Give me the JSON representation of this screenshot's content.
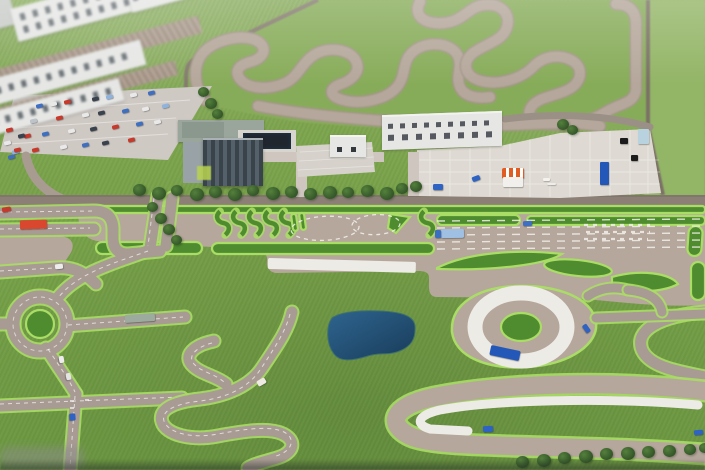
{
  "scene": {
    "subject": "Aerial photograph of a miniature scale model of a vehicle proving ground and driver training facility",
    "features": [
      "winding handling course",
      "grandstand buildings",
      "visitor parking lot with cars",
      "office building",
      "workshop hall",
      "concrete apron with equipment",
      "slalom practice islands",
      "dashed steering circles",
      "multi-lane braking straight with white stripe",
      "roundabout",
      "city practice streets",
      "serpentine practice road",
      "dark blue pond",
      "wet skid pad ring",
      "high-speed hairpin bend with white curve marking",
      "tree rows"
    ]
  },
  "colors": {
    "grass_base": "#79a24a",
    "grass_field": "#87ac59",
    "grass_right": "#93b566",
    "island_green": "#4f8c30",
    "island_edge": "#aadd66",
    "track_tan": "#b5a79b",
    "road_grey": "#a89b93",
    "main_road": "#8c8076",
    "apron": "#dedad3",
    "white_paint": "#edebe5",
    "building_white": "#e6e7e5",
    "glass_dark": "#4b555c",
    "pond_dark": "#16395b",
    "pond_light": "#2d6492",
    "tent_orange": "#e05c22",
    "border_brown": "#7b7166"
  },
  "vehicles": {
    "parked_cars": [
      {
        "x": 36,
        "y": 104,
        "c": "#3f6fc0"
      },
      {
        "x": 50,
        "y": 102,
        "c": "#e9e9e9"
      },
      {
        "x": 64,
        "y": 100,
        "c": "#c6392b"
      },
      {
        "x": 92,
        "y": 97,
        "c": "#39424d"
      },
      {
        "x": 106,
        "y": 95,
        "c": "#8fb3dd"
      },
      {
        "x": 130,
        "y": 93,
        "c": "#e9e9e9"
      },
      {
        "x": 148,
        "y": 91,
        "c": "#3f6fc0"
      },
      {
        "x": 30,
        "y": 119,
        "c": "#bcc3c9"
      },
      {
        "x": 56,
        "y": 116,
        "c": "#c6392b"
      },
      {
        "x": 82,
        "y": 113,
        "c": "#e9e9e9"
      },
      {
        "x": 98,
        "y": 111,
        "c": "#39424d"
      },
      {
        "x": 122,
        "y": 109,
        "c": "#3f6fc0"
      },
      {
        "x": 142,
        "y": 107,
        "c": "#e9e9e9"
      },
      {
        "x": 162,
        "y": 104,
        "c": "#8fb3dd"
      },
      {
        "x": 24,
        "y": 134,
        "c": "#c6392b"
      },
      {
        "x": 42,
        "y": 132,
        "c": "#3f6fc0"
      },
      {
        "x": 68,
        "y": 129,
        "c": "#e9e9e9"
      },
      {
        "x": 90,
        "y": 127,
        "c": "#39424d"
      },
      {
        "x": 112,
        "y": 125,
        "c": "#c6392b"
      },
      {
        "x": 136,
        "y": 122,
        "c": "#3f6fc0"
      },
      {
        "x": 154,
        "y": 120,
        "c": "#e9e9e9"
      },
      {
        "x": 12,
        "y": 150,
        "c": "#8fb3dd"
      },
      {
        "x": 32,
        "y": 148,
        "c": "#c6392b"
      },
      {
        "x": 60,
        "y": 145,
        "c": "#e9e9e9"
      },
      {
        "x": 82,
        "y": 143,
        "c": "#3f6fc0"
      },
      {
        "x": 102,
        "y": 141,
        "c": "#39424d"
      },
      {
        "x": 128,
        "y": 138,
        "c": "#c6392b"
      },
      {
        "x": 6,
        "y": 128,
        "c": "#c6392b"
      },
      {
        "x": 18,
        "y": 134,
        "c": "#39424d"
      },
      {
        "x": 4,
        "y": 141,
        "c": "#e9e9e9"
      },
      {
        "x": 14,
        "y": 148,
        "c": "#c6392b"
      },
      {
        "x": 8,
        "y": 155,
        "c": "#3f6fc0"
      }
    ],
    "road_vehicles": [
      {
        "name": "red-bus",
        "x": 20,
        "y": 220,
        "w": 27,
        "h": 9,
        "rot": -2,
        "color": "#d9472f"
      },
      {
        "name": "red-car",
        "x": 2,
        "y": 207,
        "w": 9,
        "h": 5,
        "rot": -8,
        "color": "#c23b2e"
      },
      {
        "name": "blue-truck-trailer",
        "x": 441,
        "y": 229,
        "w": 23,
        "h": 9,
        "rot": -1,
        "color": "#9fc0e2"
      },
      {
        "name": "blue-truck-cab",
        "x": 435,
        "y": 230,
        "w": 6,
        "h": 8,
        "rot": -1,
        "color": "#3a6ec0"
      },
      {
        "name": "blue-car-lanes",
        "x": 523,
        "y": 221,
        "w": 9,
        "h": 5,
        "rot": -2,
        "color": "#3f6fc0"
      },
      {
        "name": "grey-bus",
        "x": 125,
        "y": 314,
        "w": 30,
        "h": 8,
        "rot": -4,
        "color": "#9cab9e"
      },
      {
        "name": "white-car-crossroad",
        "x": 55,
        "y": 264,
        "w": 8,
        "h": 5,
        "rot": -6,
        "color": "#ececec"
      },
      {
        "name": "white-car-avenue-1",
        "x": 58,
        "y": 357,
        "w": 7,
        "h": 5,
        "rot": 80,
        "color": "#ececec"
      },
      {
        "name": "white-car-avenue-2",
        "x": 65,
        "y": 374,
        "w": 7,
        "h": 5,
        "rot": 80,
        "color": "#e4e4e4"
      },
      {
        "name": "blue-car-junction",
        "x": 69,
        "y": 414,
        "w": 7,
        "h": 6,
        "rot": 85,
        "color": "#2e63c4"
      },
      {
        "name": "white-red-car-serpentine",
        "x": 257,
        "y": 379,
        "w": 9,
        "h": 6,
        "rot": -30,
        "color": "#efe9e4"
      },
      {
        "name": "blue-truck-skidpad",
        "x": 490,
        "y": 348,
        "w": 30,
        "h": 10,
        "rot": 12,
        "color": "#2458b8"
      },
      {
        "name": "blue-car-skidpad",
        "x": 582,
        "y": 326,
        "w": 9,
        "h": 5,
        "rot": 55,
        "color": "#2e63c4"
      },
      {
        "name": "blue-car-hairpin",
        "x": 483,
        "y": 426,
        "w": 10,
        "h": 6,
        "rot": -3,
        "color": "#2e63c4"
      },
      {
        "name": "blue-car-bottom-right",
        "x": 694,
        "y": 430,
        "w": 9,
        "h": 5,
        "rot": -5,
        "color": "#2e63c4"
      },
      {
        "name": "blue-car-apron",
        "x": 472,
        "y": 176,
        "w": 8,
        "h": 5,
        "rot": -20,
        "color": "#2e63c4"
      },
      {
        "name": "blue-bin-apron",
        "x": 433,
        "y": 184,
        "w": 10,
        "h": 6,
        "rot": 0,
        "color": "#2e63c4"
      }
    ]
  },
  "apron_objects": [
    {
      "name": "orange-tent-roof",
      "x": 502,
      "y": 168,
      "w": 22,
      "h": 10,
      "type": "striped"
    },
    {
      "name": "tent-body",
      "x": 503,
      "y": 177,
      "w": 20,
      "h": 10,
      "color": "#f2f0ec"
    },
    {
      "name": "blue-container",
      "x": 600,
      "y": 162,
      "w": 9,
      "h": 23,
      "color": "#2458b8"
    },
    {
      "name": "black-crate-1",
      "x": 620,
      "y": 138,
      "w": 8,
      "h": 6,
      "color": "#1c1c1c"
    },
    {
      "name": "black-crate-2",
      "x": 631,
      "y": 155,
      "w": 7,
      "h": 6,
      "color": "#1c1c1c"
    },
    {
      "name": "pale-blue-cabinet",
      "x": 638,
      "y": 129,
      "w": 11,
      "h": 15,
      "color": "#b9d2df"
    },
    {
      "name": "white-pallet-1",
      "x": 543,
      "y": 178,
      "w": 7,
      "h": 3,
      "color": "#f4f2ee"
    },
    {
      "name": "white-pallet-2",
      "x": 547,
      "y": 183,
      "w": 9,
      "h": 2,
      "color": "#efede9"
    }
  ],
  "trees": {
    "main_row": [
      {
        "x": 133,
        "y": 184,
        "s": 13
      },
      {
        "x": 152,
        "y": 187,
        "s": 14
      },
      {
        "x": 171,
        "y": 185,
        "s": 12
      },
      {
        "x": 190,
        "y": 188,
        "s": 14
      },
      {
        "x": 209,
        "y": 186,
        "s": 13
      },
      {
        "x": 228,
        "y": 188,
        "s": 14
      },
      {
        "x": 247,
        "y": 185,
        "s": 12
      },
      {
        "x": 266,
        "y": 187,
        "s": 14
      },
      {
        "x": 285,
        "y": 186,
        "s": 13
      },
      {
        "x": 304,
        "y": 188,
        "s": 13
      },
      {
        "x": 323,
        "y": 186,
        "s": 14
      },
      {
        "x": 342,
        "y": 187,
        "s": 12
      },
      {
        "x": 361,
        "y": 185,
        "s": 13
      },
      {
        "x": 380,
        "y": 187,
        "s": 14
      },
      {
        "x": 396,
        "y": 183,
        "s": 12
      },
      {
        "x": 410,
        "y": 181,
        "s": 12
      }
    ],
    "bottom_right_row": [
      {
        "x": 516,
        "y": 456,
        "s": 13
      },
      {
        "x": 537,
        "y": 454,
        "s": 14
      },
      {
        "x": 558,
        "y": 452,
        "s": 13
      },
      {
        "x": 579,
        "y": 450,
        "s": 14
      },
      {
        "x": 600,
        "y": 448,
        "s": 13
      },
      {
        "x": 621,
        "y": 447,
        "s": 14
      },
      {
        "x": 642,
        "y": 446,
        "s": 13
      },
      {
        "x": 663,
        "y": 445,
        "s": 13
      },
      {
        "x": 684,
        "y": 444,
        "s": 12
      },
      {
        "x": 699,
        "y": 443,
        "s": 11
      }
    ],
    "city_column": [
      {
        "x": 147,
        "y": 202,
        "s": 11
      },
      {
        "x": 155,
        "y": 213,
        "s": 12
      },
      {
        "x": 163,
        "y": 224,
        "s": 12
      },
      {
        "x": 171,
        "y": 235,
        "s": 11
      }
    ],
    "parking_edge": [
      {
        "x": 198,
        "y": 87,
        "s": 11
      },
      {
        "x": 205,
        "y": 98,
        "s": 12
      },
      {
        "x": 212,
        "y": 109,
        "s": 11
      }
    ],
    "apron_corner": [
      {
        "x": 557,
        "y": 119,
        "s": 12
      },
      {
        "x": 567,
        "y": 125,
        "s": 11
      }
    ]
  }
}
